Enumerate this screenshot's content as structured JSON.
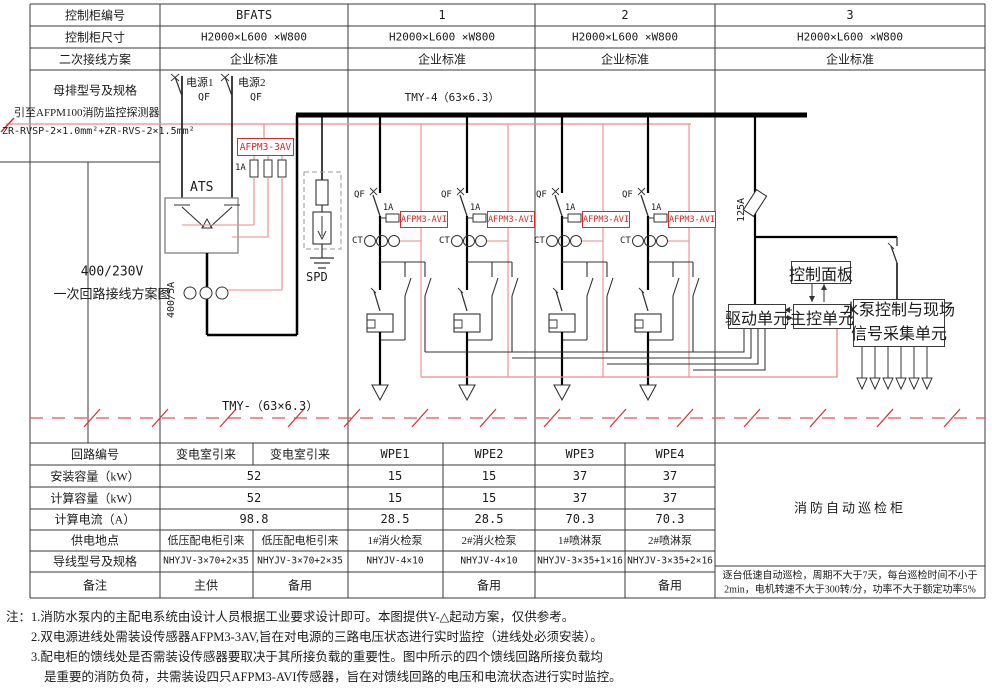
{
  "colors": {
    "accent_red": "#d42a2a",
    "wire_red": "#ef8a8a",
    "line_black": "#333333"
  },
  "top_table": {
    "row_labels": [
      "控制柜编号",
      "控制柜尺寸",
      "二次接线方案"
    ],
    "cabinet_ids": [
      "BFATS",
      "1",
      "2",
      "3"
    ],
    "dimensions": [
      "H2000×L600 ×W800",
      "H2000×L600 ×W800",
      "H2000×L600 ×W800",
      "H2000×L600 ×W800"
    ],
    "schemes": [
      "企业标准",
      "企业标准",
      "企业标准",
      "企业标准"
    ],
    "busbar_label": "母排型号及规格",
    "busbar_spec": "TMY-4（63×6.3）"
  },
  "diagram": {
    "row_label_line1": "400/230V",
    "row_label_line2": "一次回路接线方案图",
    "afpm_leader": "引至AFPM100消防监控探测器",
    "cable_spec": "ZR-RVSP-2×1.0mm²+ZR-RVS-2×1.5mm²",
    "source1": "电源1",
    "source2": "电源2",
    "qf": "QF",
    "incomer_sensor": "AFPM3-3AV",
    "sensor_fuse": "1A",
    "ats": "ATS",
    "ct_ratio": "400/5A",
    "spd": "SPD",
    "feeder_breaker": "QF",
    "feeder_fuse": "1A",
    "feeder_sensor": "AFPM3-AVI",
    "feeder_ct": "CT",
    "bottom_bus_spec": "TMY-（63×6.3）",
    "inspection_fuse": "125A",
    "control_panel": "控制面板",
    "drive_unit": "驱动单元",
    "main_unit": "主控单元",
    "pump_unit_line1": "水泵控制与现场",
    "pump_unit_line2": "信号采集单元"
  },
  "bottom_table": {
    "row_labels": [
      "回路编号",
      "安装容量（kW）",
      "计算容量（kW）",
      "计算电流（A）",
      "供电地点",
      "导线型号及规格",
      "备注"
    ],
    "circuit_ids": [
      "变电室引来",
      "变电室引来",
      "WPE1",
      "WPE2",
      "WPE3",
      "WPE4"
    ],
    "installed_kw": {
      "incomer": "52",
      "feeders": [
        "15",
        "15",
        "37",
        "37"
      ]
    },
    "calculated_kw": {
      "incomer": "52",
      "feeders": [
        "15",
        "15",
        "37",
        "37"
      ]
    },
    "calculated_a": {
      "incomer": "98.8",
      "feeders": [
        "28.5",
        "28.5",
        "70.3",
        "70.3"
      ]
    },
    "supply_points": [
      "低压配电柜引来",
      "低压配电柜引来",
      "1#消火检泵",
      "2#消火检泵",
      "1#喷淋泵",
      "2#喷淋泵"
    ],
    "wire_specs": [
      "NHYJV-3×70+2×35",
      "NHYJV-3×70+2×35",
      "NHYJV-4×10",
      "NHYJV-4×10",
      "NHYJV-3×35+1×16",
      "NHYJV-3×35+2×16"
    ],
    "remarks": [
      "主供",
      "备用",
      "",
      "备用",
      "",
      "备用"
    ]
  },
  "inspection_cabinet": {
    "title": "消防自动巡检柜",
    "note_line1": "逐台低速自动巡检，周期不大于7天，每台巡检时间不小于",
    "note_line2": "2min，电机转速不大于300转/分，功率不大于额定功率5%"
  },
  "notes": {
    "prefix": "注：",
    "line1": "1.消防水泵内的主配电系统由设计人员根据工业要求设计即可。本图提供Y-△起动方案，仅供参考。",
    "line2": "2.双电源进线处需装设传感器AFPM3-3AV,旨在对电源的三路电压状态进行实时监控（进线处必须安装）。",
    "line3": "3.配电柜的馈线处是否需装设传感器要取决于其所接负载的重要性。图中所示的四个馈线回路所接负载均",
    "line4": "是重要的消防负荷，共需装设四只AFPM3-AVI传感器，旨在对馈线回路的电压和电流状态进行实时监控。"
  }
}
